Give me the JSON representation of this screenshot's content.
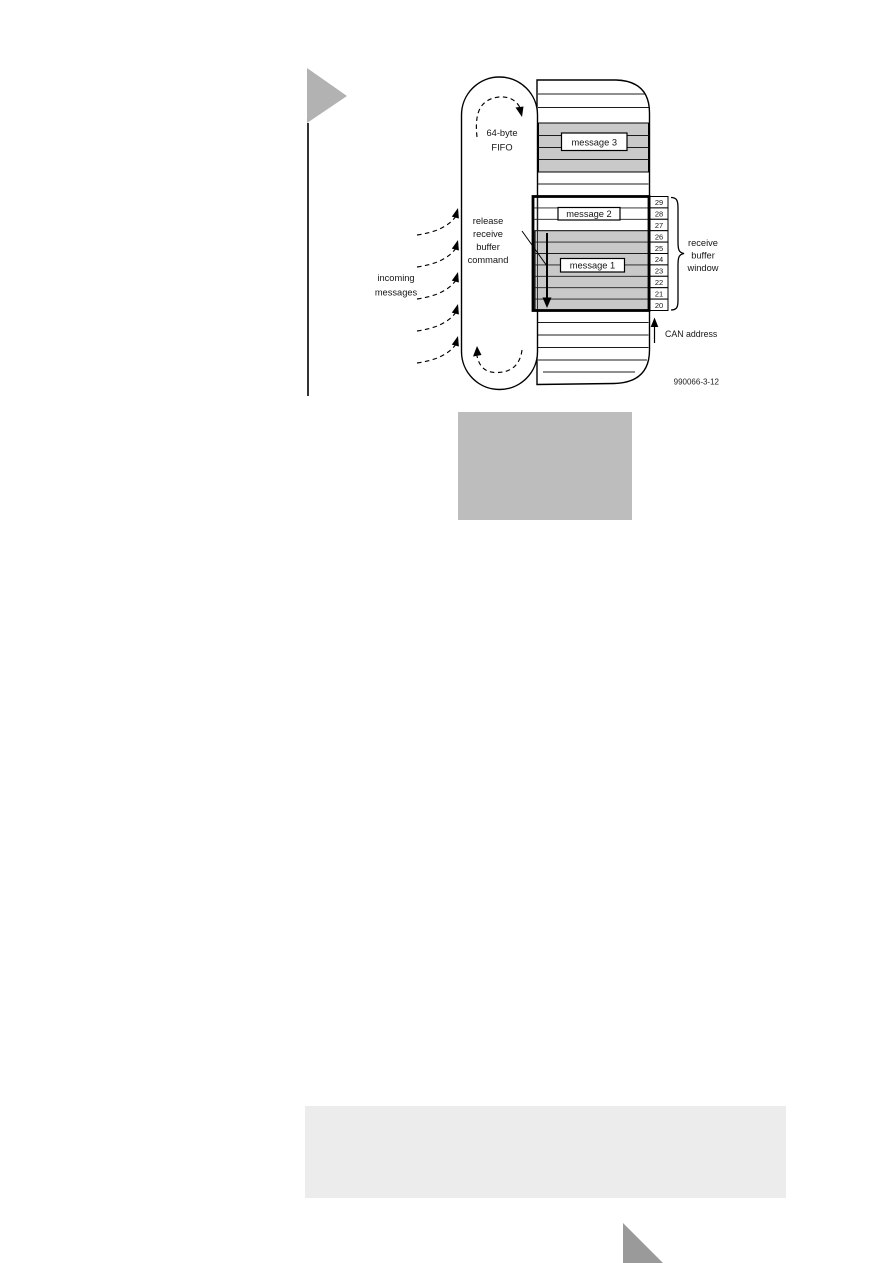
{
  "figure": {
    "fifo_label_line1": "64-byte",
    "fifo_label_line2": "FIFO",
    "message3": "message 3",
    "message2": "message 2",
    "message1": "message 1",
    "release_cmd_line1": "release",
    "release_cmd_line2": "receive",
    "release_cmd_line3": "buffer",
    "release_cmd_line4": "command",
    "incoming_line1": "incoming",
    "incoming_line2": "messages",
    "window_label_line1": "receive",
    "window_label_line2": "buffer",
    "window_label_line3": "window",
    "can_address_label": "CAN address",
    "figure_code": "990066-3-12",
    "addresses": [
      "29",
      "28",
      "27",
      "26",
      "25",
      "24",
      "23",
      "22",
      "21",
      "20"
    ]
  },
  "colors": {
    "band_gray": "#c9c9c9",
    "window_gray": "#c9c9c9",
    "placeholder_gray": "#bdbdbd",
    "footer_gray": "#ececec",
    "marker_gray": "#b2b2b2",
    "corner_gray": "#9a9a9a"
  }
}
